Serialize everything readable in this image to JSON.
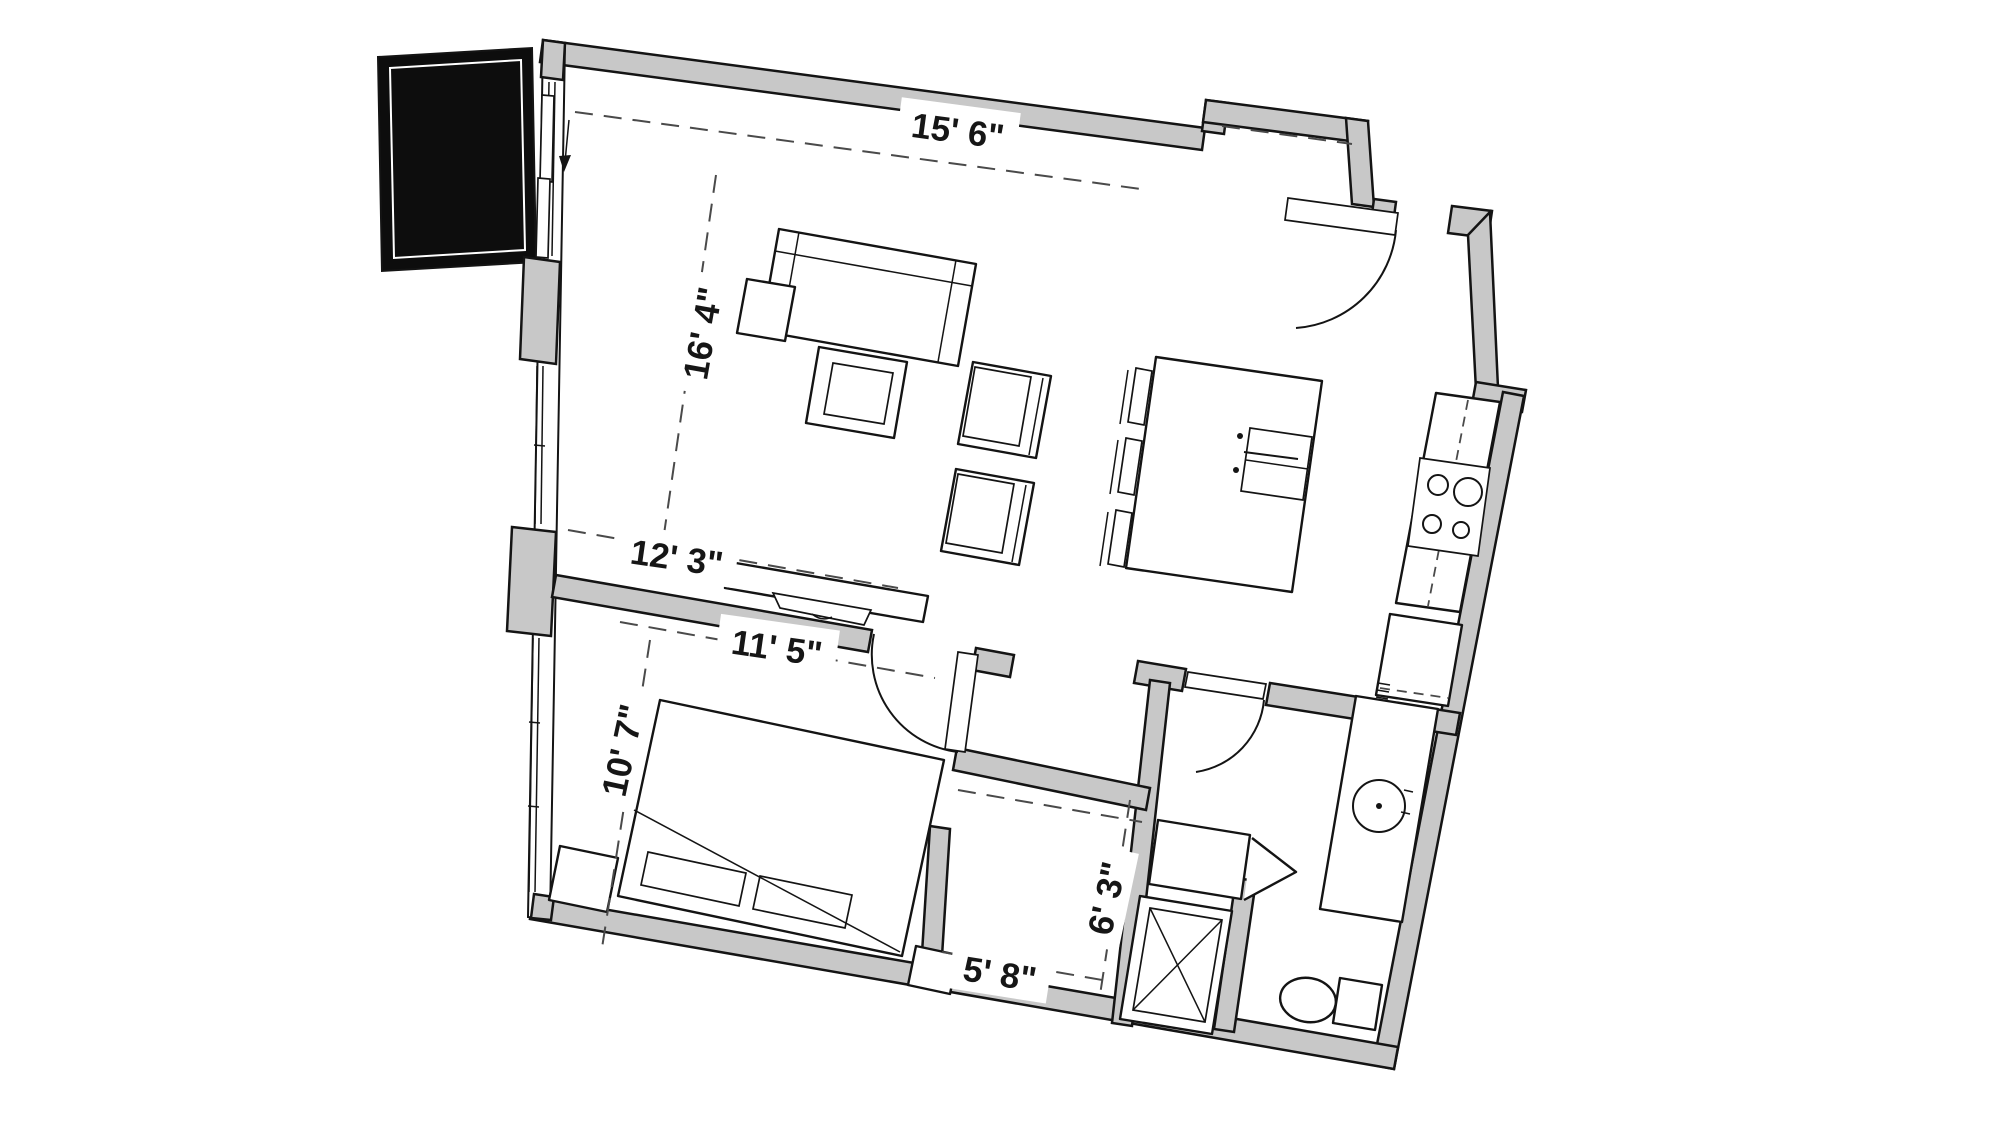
{
  "floor_plan": {
    "type": "apartment-unit-floor-plan",
    "dimensions": {
      "living_width_top": "15' 6\"",
      "living_depth_left": "16' 4\"",
      "living_width_bottom": "12' 3\"",
      "bedroom_width": "11' 5\"",
      "bedroom_depth": "10' 7\"",
      "closet_depth": "6' 3\"",
      "closet_width": "5' 8\""
    },
    "colors": {
      "floor": "#ffffff",
      "wall_fill": "#c8c8c8",
      "line": "#141414",
      "balcony_fill": "#0d0d0d",
      "dimension_dash": "#4a4a4a",
      "label_text": "#161616",
      "label_background": "#ffffff"
    },
    "fixtures": [
      "balcony",
      "sliding-balcony-door",
      "window-wall",
      "sofa",
      "end-table",
      "coffee-table",
      "armchair",
      "armchair",
      "tv-console",
      "kitchen-island",
      "island-sink",
      "bar-stool",
      "bar-stool",
      "bar-stool",
      "kitchen-counter",
      "cooktop-4-burner",
      "lower-cabinet",
      "entry-door",
      "bedroom-door",
      "bathroom-door",
      "bed",
      "pillow",
      "pillow",
      "nightstand",
      "nightstand",
      "walk-in-closet",
      "bifold-closet",
      "stacked-washer-dryer",
      "bathroom-vanity",
      "round-sink",
      "toilet"
    ]
  }
}
